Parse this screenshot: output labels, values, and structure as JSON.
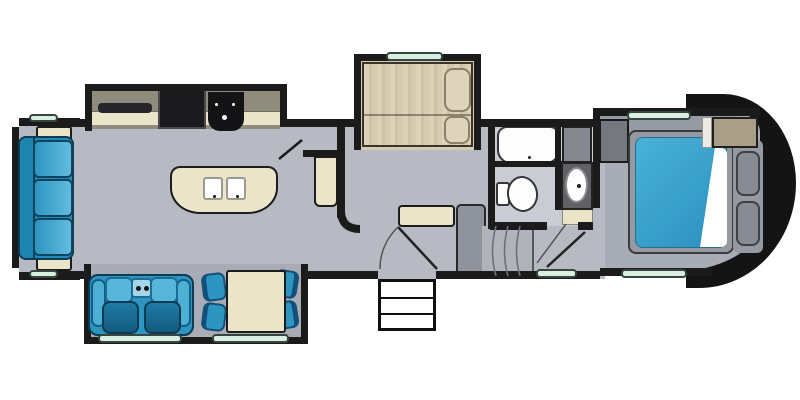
{
  "diagram": {
    "type": "rv-fifth-wheel-floorplan",
    "orientation": "hitch-end-right, rear-left, top-down view",
    "rooms": [
      "rear living room",
      "kitchen",
      "entry hall",
      "bathroom",
      "front bedroom"
    ],
    "slide_outs": [
      "rear sofa slide-out",
      "kitchen appliance slide-out",
      "sofa-bed slide-out",
      "theater-seat and dinette slide-out"
    ],
    "colors": {
      "wall": "#1b1b1b",
      "floor": "#b7bac2",
      "slide_floor": "#a9acb4",
      "bath_floor": "#c9ccd3",
      "bedroom_floor": "#a8acb4",
      "cream": "#eae4c8",
      "mattress_tan": "#d6cbb1",
      "furniture_blue": "#2d95c0",
      "furniture_blue_light": "#57b6da",
      "furniture_blue_dark": "#1a6d94",
      "bed_blue": "#3ba6d0",
      "window_green": "#d9efe2",
      "appliance_black": "#1b1b1d",
      "kitchen_slide_interior": "#8f8c7d",
      "cabinet_gray": "#8f939c",
      "front_cap": "#141414",
      "fixture_white": "#fdfdfd"
    }
  },
  "labels": {
    "rear_wall": "Rear Wall",
    "rear_sofa": "Sofa",
    "end_table_top": "End Table",
    "end_table_bottom": "End Table",
    "kitchen_counter": "Kitchen Counter",
    "tv_shelf": "TV Shelf",
    "refrigerator": "Refrigerator",
    "range": "Range Cooktop",
    "island_sink": "Kitchen Island with Double Sink",
    "pantry": "Pantry",
    "partition_wall": "Partition Wall",
    "sofa_bed": "Tri-Fold Sofa Bed Slide-Out",
    "pillow": "Pillow",
    "theater_seating": "Theater Seating with Cupholders",
    "dinette_table": "Dinette Table",
    "dinette_chair": "Dinette Chair",
    "bench": "Bench Seat",
    "hall_cabinet": "Cabinet",
    "entry_door": "Entry Door Swing",
    "entry_steps": "Entry Steps",
    "interior_steps": "Steps to Bedroom",
    "shower_tub": "Tub / Shower",
    "linen_closet": "Linen Closet",
    "toilet": "Toilet",
    "vanity_sink": "Vanity Sink",
    "bath_door": "Bathroom Door Swing",
    "queen_bed": "Queen Bed",
    "bed_platform": "Bed Platform",
    "nightstand": "Nightstand / Pillows",
    "overhead_cabinet": "Overhead Cabinet",
    "wardrobe": "Wardrobe / Dresser",
    "front_cap": "Front Cap (Hitch End)",
    "window": "Window"
  }
}
